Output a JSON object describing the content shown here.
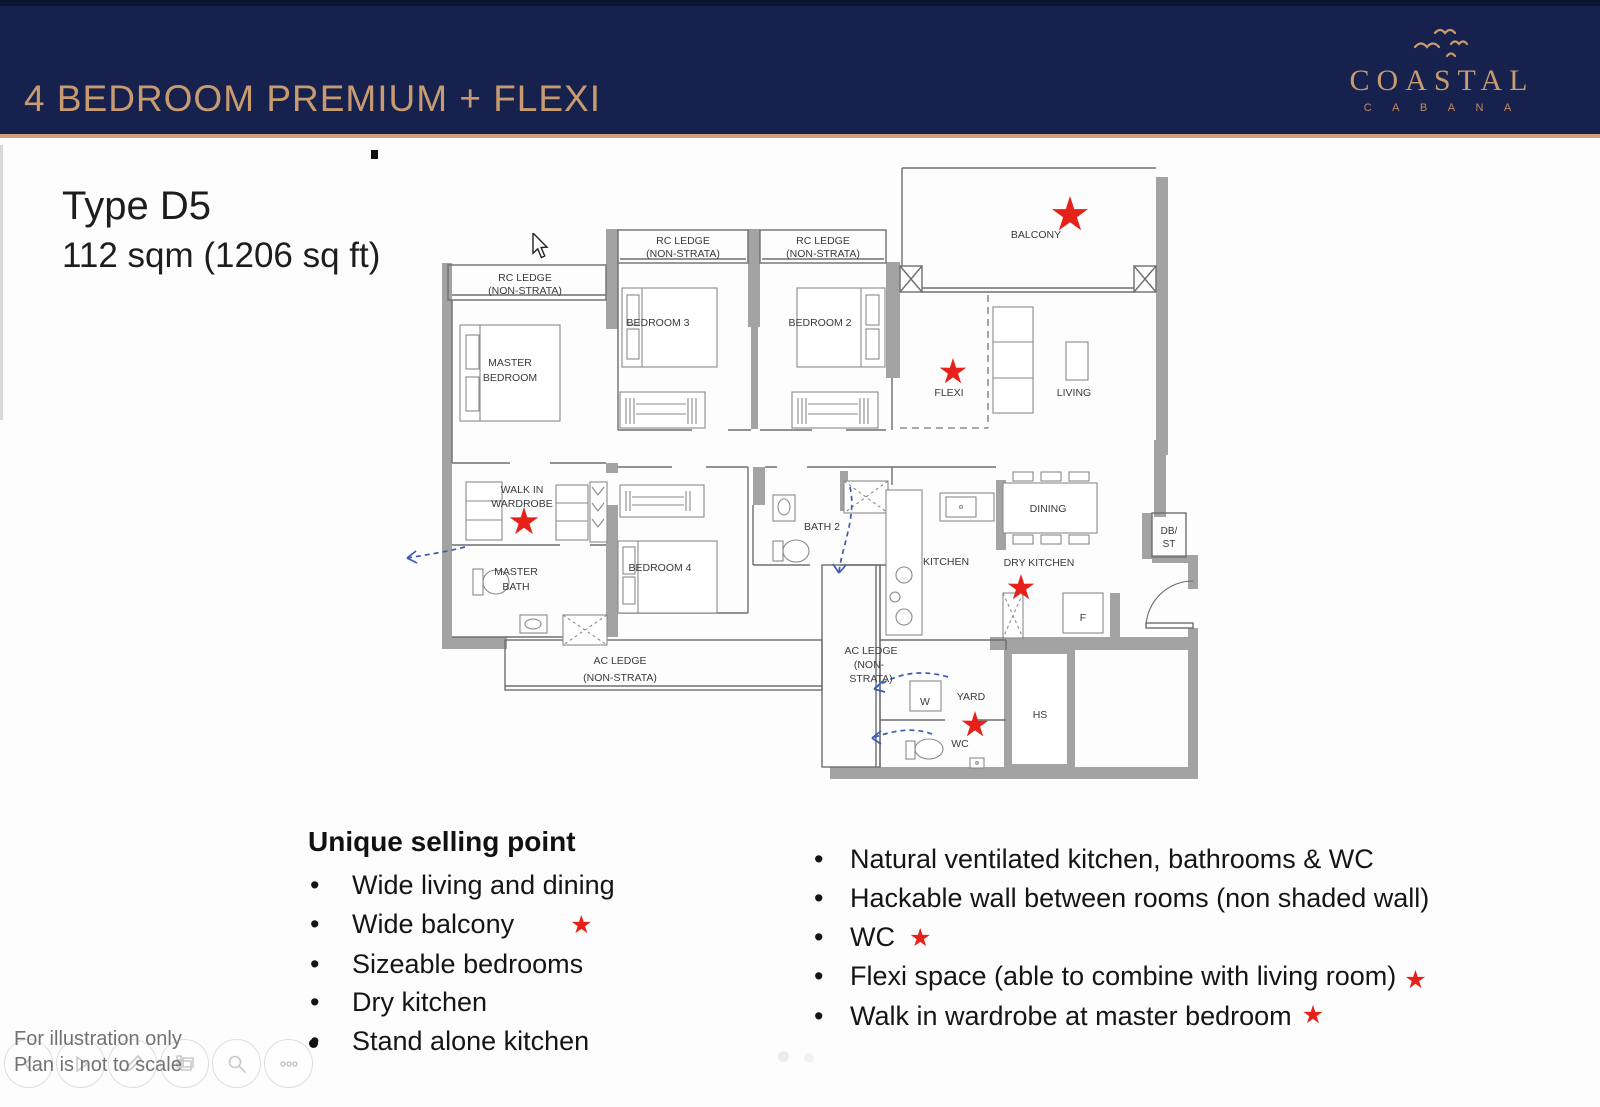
{
  "header": {
    "title": "4 BEDROOM PREMIUM + FLEXI",
    "bg_color": "#16224d",
    "accent_color": "#c89a6f",
    "logo": {
      "name": "COASTAL",
      "sub": "C A B A N A"
    }
  },
  "unit": {
    "type": "Type D5",
    "area": "112 sqm (1206 sq ft)"
  },
  "plan": {
    "star_color": "#e62119",
    "wall_color": "#a3a3a3",
    "arrow_color": "#3b5bb5",
    "labels": {
      "rc_ledge": "RC LEDGE",
      "non_strata": "(NON-STRATA)",
      "master": "MASTER",
      "bedroom": "BEDROOM",
      "bedroom3": "BEDROOM 3",
      "bedroom2": "BEDROOM 2",
      "balcony": "BALCONY",
      "flexi": "FLEXI",
      "living": "LIVING",
      "walk_in": "WALK IN",
      "wardrobe": "WARDROBE",
      "bath": "BATH",
      "bedroom4": "BEDROOM 4",
      "bath2": "BATH 2",
      "kitchen": "KITCHEN",
      "dry_kitchen": "DRY KITCHEN",
      "dining": "DINING",
      "ac_ledge": "AC LEDGE",
      "non_short": "(NON-",
      "strata_short": "STRATA)",
      "yard": "YARD",
      "wc": "WC",
      "hs": "HS",
      "w": "W",
      "f": "F",
      "db": "DB/",
      "st": "ST"
    }
  },
  "usp": {
    "heading": "Unique selling point",
    "items": [
      "Wide living and dining",
      "Wide balcony",
      "Sizeable bedrooms",
      "Dry kitchen",
      "Stand alone kitchen"
    ]
  },
  "features": {
    "items": [
      "Natural ventilated kitchen, bathrooms & WC",
      "Hackable wall between rooms (non shaded wall)",
      "WC",
      "Flexi space (able to combine with living room)",
      "Walk in wardrobe at master bedroom"
    ]
  },
  "footer": {
    "note_line1": "For illustration only",
    "note_line2": "Plan is not to scale",
    "toolbar_icons": [
      "chevron-left",
      "play",
      "pen",
      "slides",
      "magnifier",
      "more-dots"
    ]
  }
}
